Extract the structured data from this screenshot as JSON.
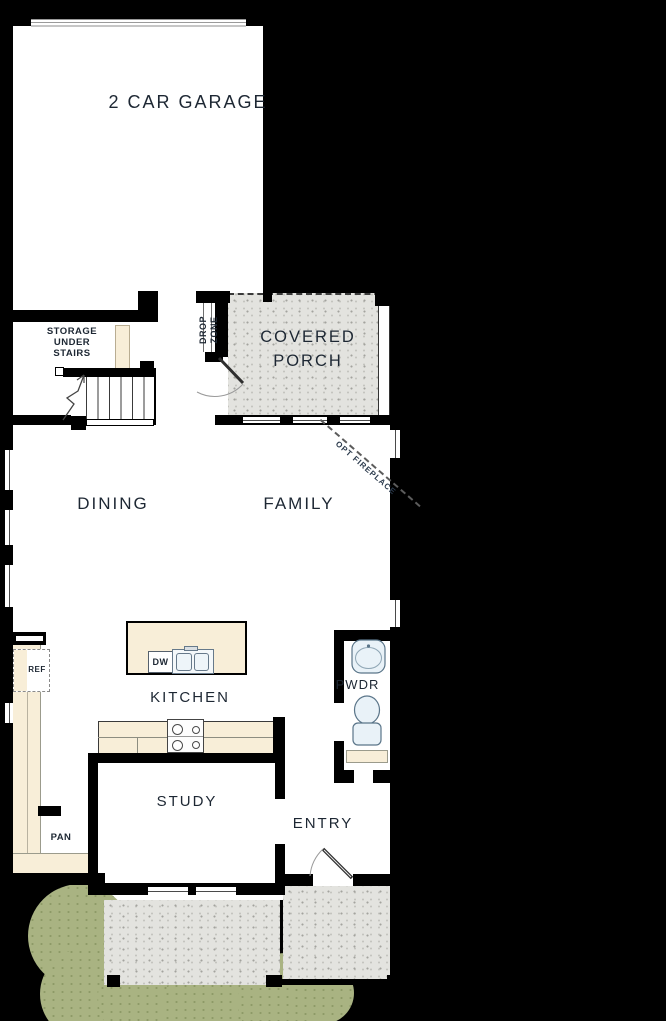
{
  "title": "First Floor Plan",
  "colors": {
    "background": "#000000",
    "wall": "#000000",
    "floor": "#ffffff",
    "counter": "#f8eed8",
    "porch_texture": "#e3e3df",
    "bush": "#a9b382",
    "fixture_fill": "#e9f2f8",
    "fixture_stroke": "#5a7589",
    "label_text": "#1d2733"
  },
  "rooms": {
    "garage": {
      "label": "2 CAR GARAGE"
    },
    "storage": {
      "lines": [
        "STORAGE",
        "UNDER",
        "STAIRS"
      ]
    },
    "drop_zone": {
      "lines": [
        "DROP",
        "ZONE"
      ]
    },
    "covered_porch": {
      "lines": [
        "COVERED",
        "PORCH"
      ]
    },
    "dining": {
      "label": "DINING"
    },
    "family": {
      "label": "FAMILY"
    },
    "kitchen": {
      "label": "KITCHEN"
    },
    "powder": {
      "label": "PWDR"
    },
    "study": {
      "label": "STUDY"
    },
    "entry": {
      "label": "ENTRY"
    },
    "pantry": {
      "label": "PAN"
    }
  },
  "fixtures": {
    "refrigerator": {
      "label": "REF"
    },
    "dishwasher": {
      "label": "DW"
    }
  },
  "annotations": {
    "opt_fireplace": {
      "label": "OPT FIREPLACE"
    }
  }
}
